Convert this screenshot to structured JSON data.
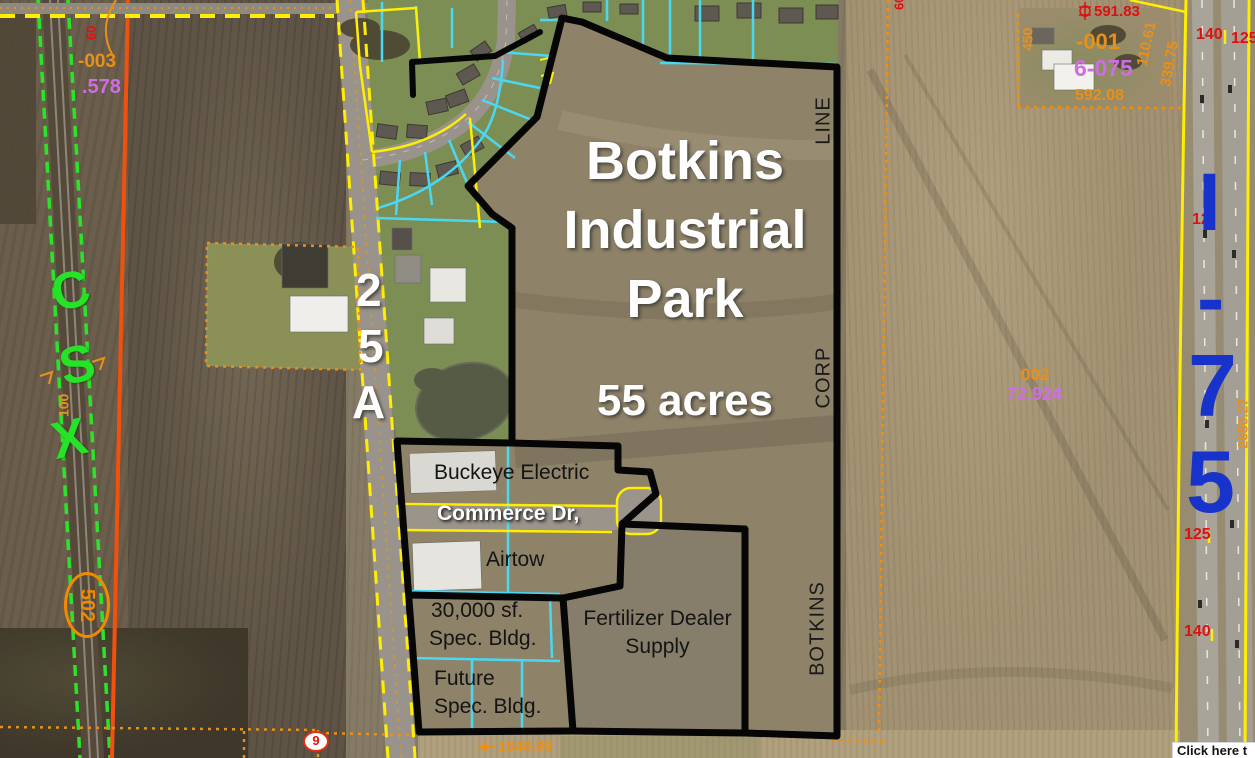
{
  "colors": {
    "park_boundary": "#000000",
    "parcel_yellow": "#ffee00",
    "parcel_cyan": "#49d7f2",
    "railroad_green": "#27e327",
    "route_orange": "#f08a00",
    "annotation_orange": "#e89018",
    "highway_blue": "#1733cc",
    "label_red": "#e01010",
    "label_purple": "#cf6ee4",
    "title_white": "#ffffff"
  },
  "park": {
    "title_line1": "Botkins",
    "title_line2": "Industrial",
    "title_line3": "Park",
    "acreage": "55 acres",
    "corp_word": "CORP",
    "line_word": "LINE",
    "botkins_word": "BOTKINS"
  },
  "businesses": {
    "buckeye": "Buckeye Electric",
    "commerce_dr": "Commerce Dr,",
    "airtow": "Airtow",
    "spec30_line1": "30,000 sf.",
    "spec30_line2": "Spec. Bldg.",
    "future_line1": "Future",
    "future_line2": "Spec. Bldg.",
    "fertilizer_line1": "Fertilizer Dealer",
    "fertilizer_line2": "Supply"
  },
  "transport": {
    "railroad": [
      "C",
      "S",
      "X"
    ],
    "route_marker": "502",
    "route_25a": [
      "2",
      "5",
      "A"
    ],
    "highway": [
      "I",
      "-",
      "7",
      "5"
    ]
  },
  "annotations": {
    "p003": "-003",
    "p003_acres": ".578",
    "dim60_left": "60",
    "dim100": "100",
    "dim60_right": "60",
    "dim591": "591.83",
    "p001": "-001",
    "p001_code": "6-075",
    "dim592": "592.08",
    "dim110": "110.61",
    "dim339": "339.75",
    "dim450": "450",
    "p002": "002",
    "p002_acres": "72.924",
    "frontage140_top": "140",
    "frontage125_top": "125",
    "frontage12": "12",
    "frontage125_mid": "125",
    "frontage140_low": "140",
    "dim2650": "2650.27",
    "dim1648": "1648.99",
    "marker9": "9"
  },
  "overlay_button": {
    "label": "Click here t"
  }
}
